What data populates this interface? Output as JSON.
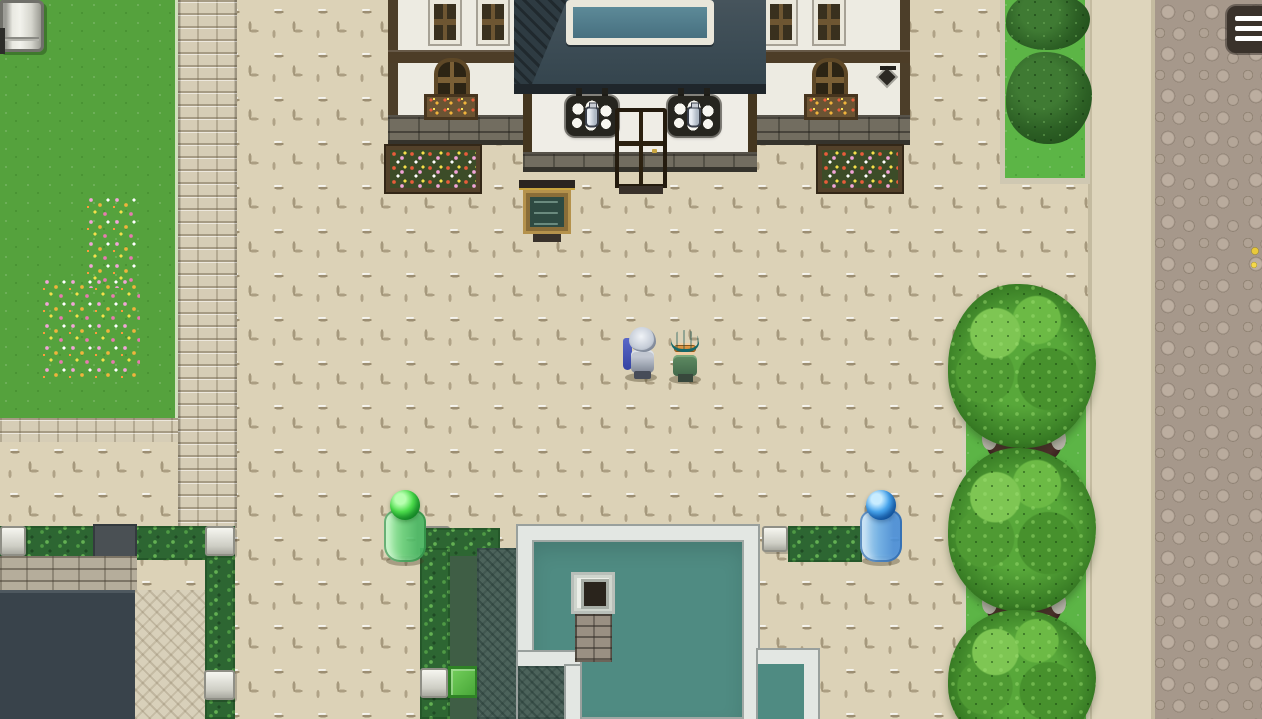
{
  "viewport": {
    "width": 1262,
    "height": 719
  },
  "ui": {
    "menu_button": {
      "icon": "hamburger-menu-icon",
      "background": "#3a322b",
      "bar_count": 3,
      "bar_color": "#ffffff"
    }
  },
  "scene": {
    "setting": "top-down pixel-art village plaza",
    "npcs": [
      {
        "name": "silver-haired-knight",
        "desc": "NPC with spiky silver hair, grey armor and blue cape",
        "hair_color": "#d6dade",
        "cape_color": "#4553b5",
        "armor_color": "#9aa1ae"
      },
      {
        "name": "teal-haired-villager",
        "desc": "NPC with teal hair, amber glasses and green coat",
        "hair_color": "#2aa5a2",
        "glasses_color": "#e6a04e",
        "coat_color": "#4f7a55"
      }
    ],
    "entities": [
      {
        "name": "green-slime-barrel",
        "desc": "translucent green barrel with shiny green orb on top",
        "orb_color": "#35c945",
        "body_color": "#6fcf84"
      },
      {
        "name": "blue-slime-barrel",
        "desc": "translucent blue barrel with shiny blue orb on top",
        "orb_color": "#2f8fe0",
        "body_color": "#6aaee8"
      },
      {
        "name": "notice-board",
        "desc": "wooden menu board with dark teal chalk panel"
      },
      {
        "name": "milk-shop-sign-left",
        "icon": "milk-jug-icon"
      },
      {
        "name": "milk-shop-sign-right",
        "icon": "milk-jug-icon"
      },
      {
        "name": "shop-door",
        "color": "#4a3920"
      },
      {
        "name": "wall-lantern",
        "icon": "lantern-icon"
      },
      {
        "name": "white-cabinet",
        "desc": "white appliance partially visible at top-left corner"
      },
      {
        "name": "yellow-flowers",
        "color": "#e9c93a"
      }
    ],
    "buildings": {
      "milk_shop": {
        "wall": "#edebe2",
        "beam": "#4d3d27",
        "roof": "#3a4c55",
        "skylight_glass": "#4e7585",
        "door": "#4a3920"
      },
      "lower_house": {
        "roof": "#4f8b82",
        "trim": "#e3e7e3",
        "chimney_brick": "#9a9083"
      },
      "dark_rooftop": {
        "color": "#39434b"
      }
    },
    "terrain": {
      "plaza": "#dcd2b7",
      "grass_left": "#55a23d",
      "grass_right": "#5cb546",
      "stone_path": "#d6cdb6",
      "rock_pavement": "#a6988b",
      "hedge": "#2d6632",
      "tree_canopy": "#3a7f26",
      "flower_colors": [
        "#f2a4d8",
        "#f0b43c",
        "#ffffff",
        "#f5e04a"
      ]
    }
  }
}
